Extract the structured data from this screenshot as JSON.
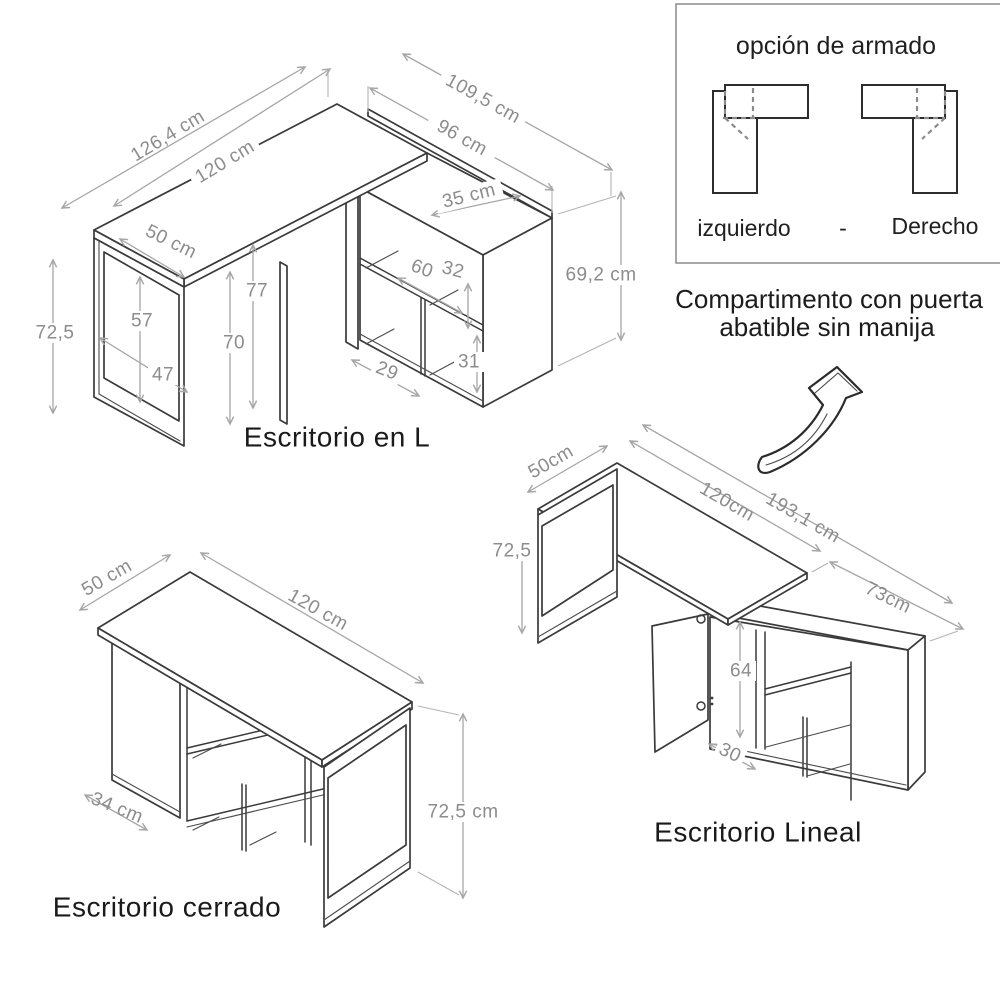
{
  "colors": {
    "furniture_line": "#3a3a3a",
    "dimension_line": "#a6a6a6",
    "dimension_text": "#8c8c8c",
    "label_text": "#1a1a1a"
  },
  "assembly_panel": {
    "title": "opción de armado",
    "left_label": "izquierdo",
    "separator": "-",
    "right_label": "Derecho"
  },
  "note": {
    "line1": "Compartimento con puerta",
    "line2": "abatible sin manija"
  },
  "l_desk": {
    "title": "Escritorio en L",
    "dim_overall_length": "126,4 cm",
    "dim_top_length": "120 cm",
    "dim_overall_depth": "109,5 cm",
    "dim_cabinet_length": "96 cm",
    "dim_cabinet_depth": "35 cm",
    "dim_desk_depth": "50 cm",
    "dim_height": "72,5",
    "dim_leg_inner_height": "57",
    "dim_leg_inner_width": "47",
    "dim_under_height": "77",
    "dim_clearance": "70",
    "dim_shelf_depth": "60",
    "dim_shelf_height": "32",
    "dim_cubby_width": "29",
    "dim_cubby_height": "31",
    "dim_cabinet_height": "69,2 cm"
  },
  "cerrado_desk": {
    "title": "Escritorio cerrado",
    "dim_depth": "50 cm",
    "dim_length": "120 cm",
    "dim_side_panel": "34 cm",
    "dim_height": "72,5 cm"
  },
  "lineal_desk": {
    "title": "Escritorio Lineal",
    "dim_depth": "50cm",
    "dim_height": "72,5",
    "dim_top_length": "120cm",
    "dim_overall_length": "193,1 cm",
    "dim_cabinet_length": "73cm",
    "dim_door_height": "64",
    "dim_door_width": "30"
  }
}
